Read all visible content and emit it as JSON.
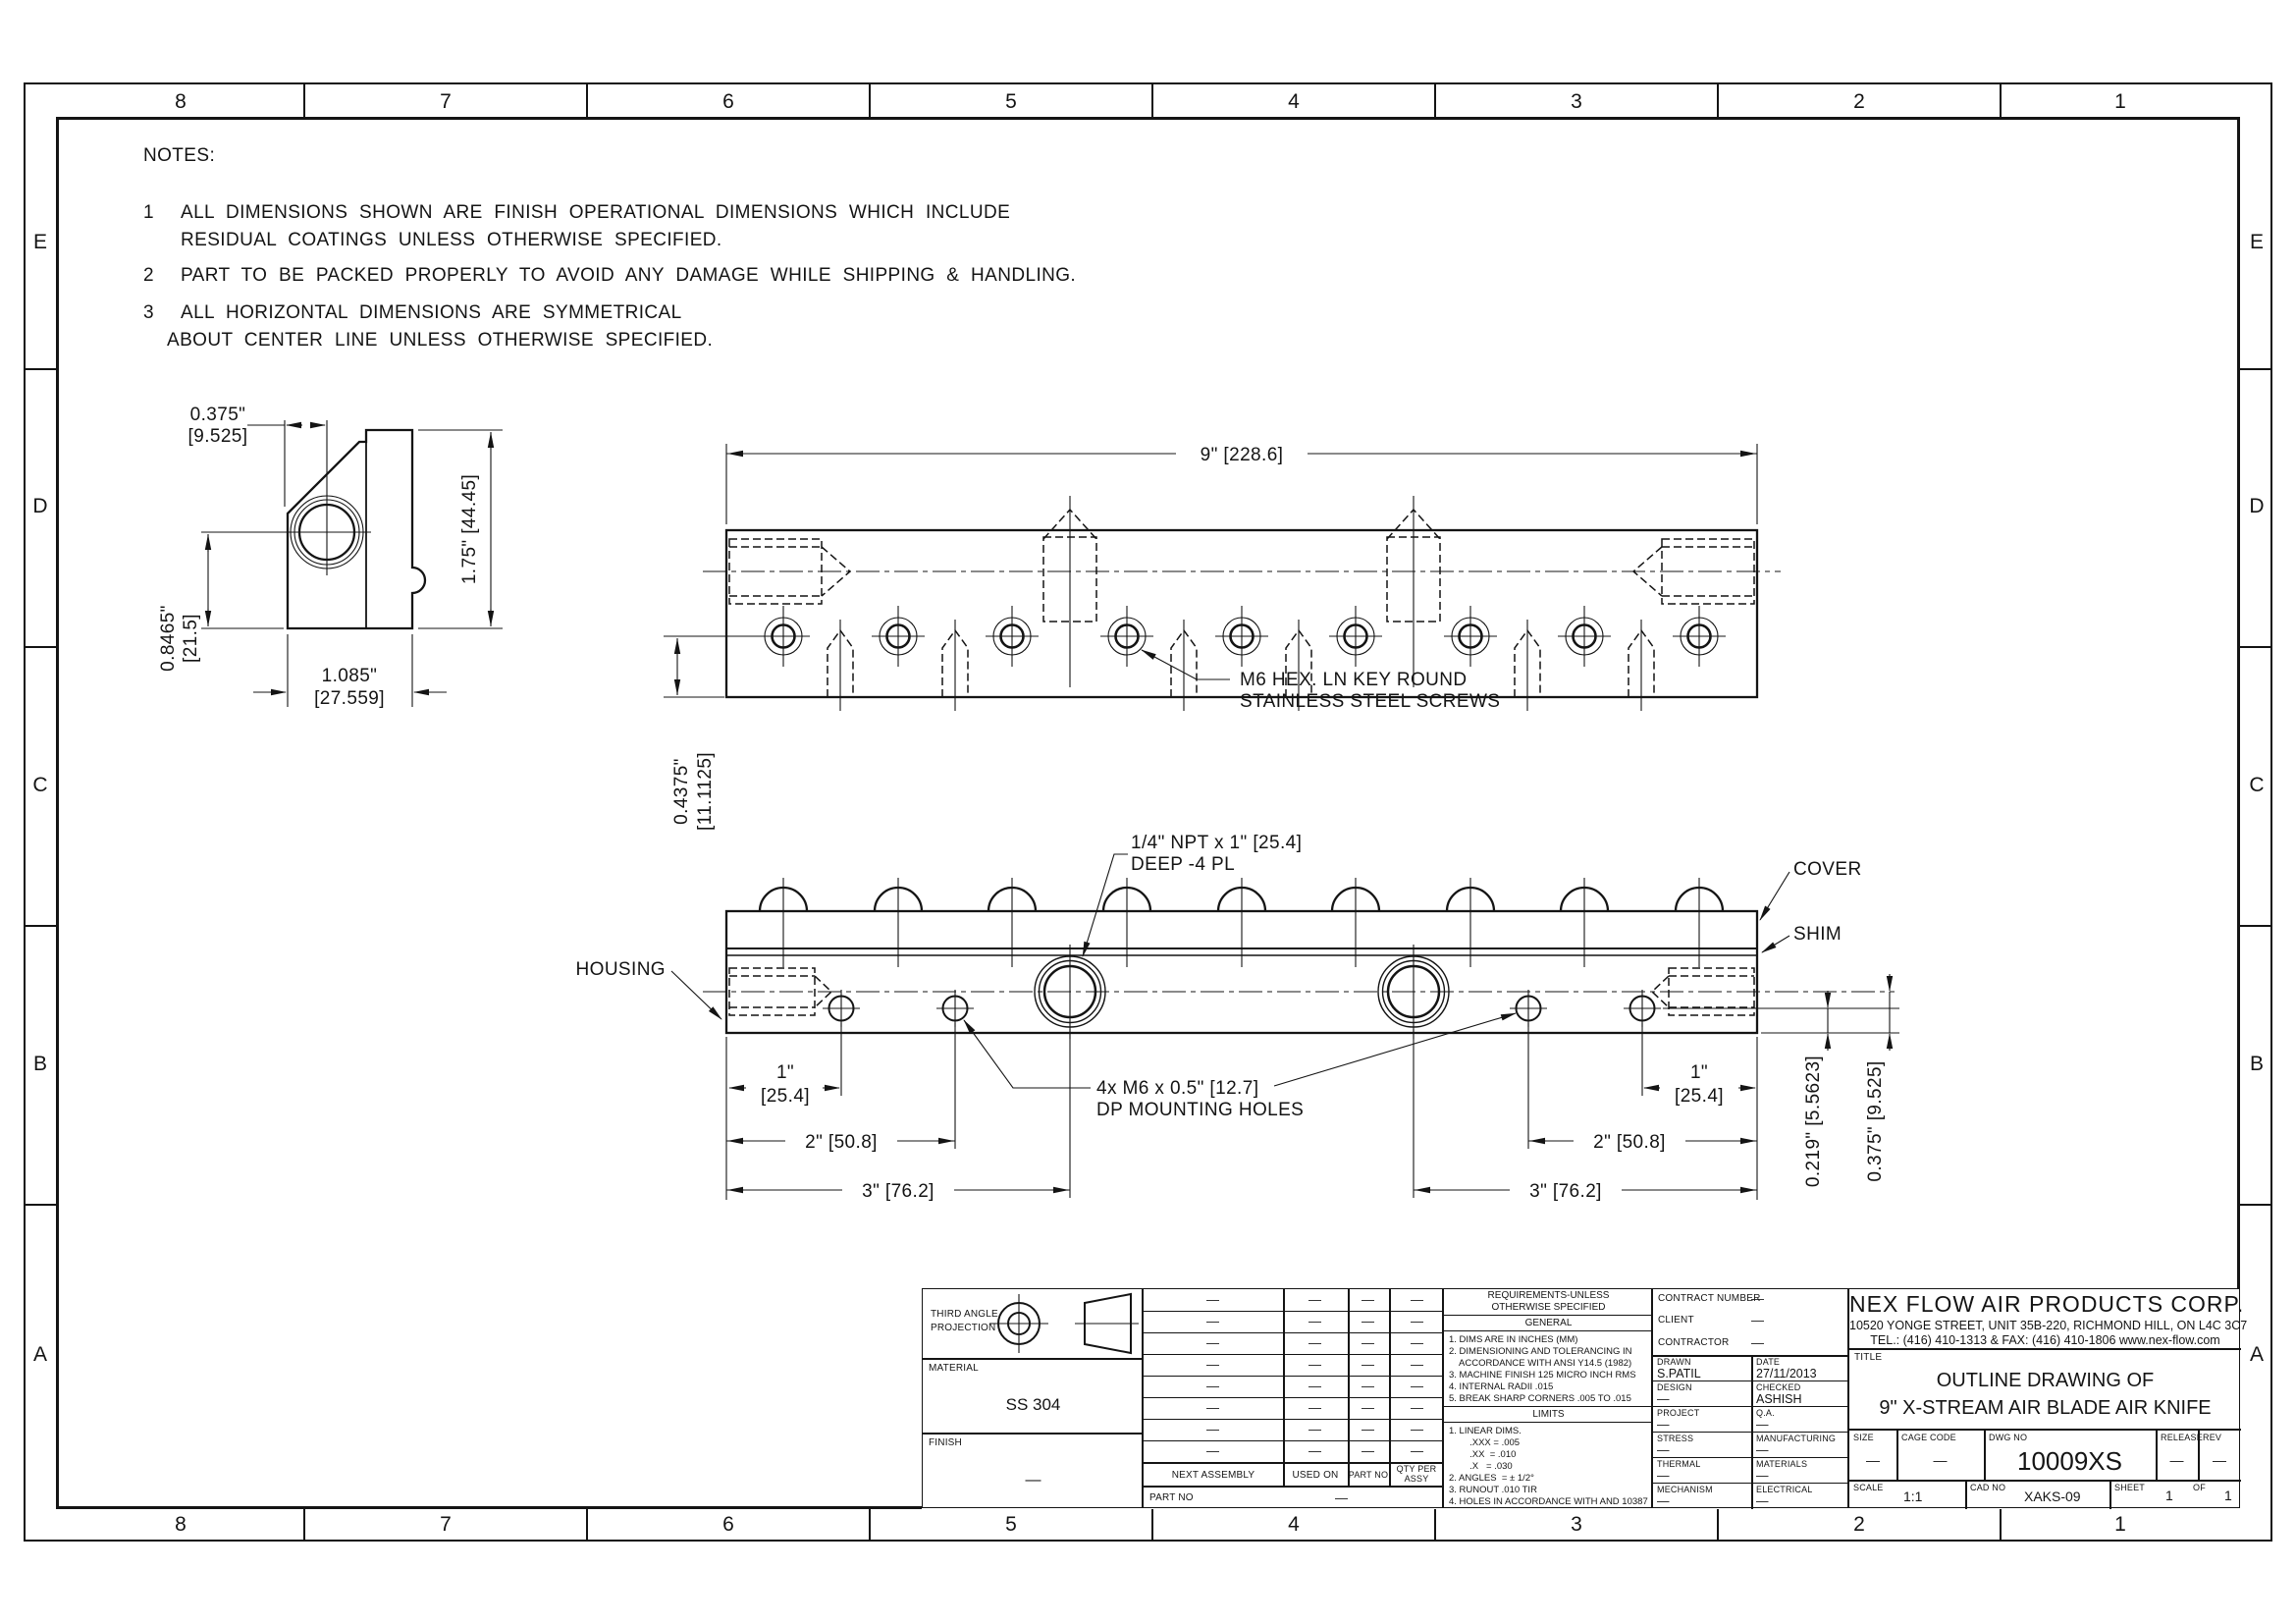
{
  "zones": {
    "cols": [
      "8",
      "7",
      "6",
      "5",
      "4",
      "3",
      "2",
      "1"
    ],
    "rows": [
      "E",
      "D",
      "C",
      "B",
      "A"
    ]
  },
  "notes": {
    "heading": "NOTES:",
    "n1_num": "1",
    "n1_line1": "ALL DIMENSIONS SHOWN ARE FINISH OPERATIONAL DIMENSIONS WHICH INCLUDE",
    "n1_line2": "RESIDUAL COATINGS UNLESS OTHERWISE SPECIFIED.",
    "n2_num": "2",
    "n2_line1": "PART TO BE PACKED PROPERLY TO AVOID ANY DAMAGE WHILE SHIPPING & HANDLING.",
    "n3_num": "3",
    "n3_line1": "ALL HORIZONTAL DIMENSIONS ARE SYMMETRICAL",
    "n3_line2": "ABOUT CENTER LINE UNLESS OTHERWISE SPECIFIED."
  },
  "side_view": {
    "dim_top_in": "0.375\"",
    "dim_top_mm": "[9.525]",
    "dim_height": "1.75\" [44.45]",
    "dim_left_in": "0.8465\"",
    "dim_left_mm": "[21.5]",
    "dim_bottom_in": "1.085\"",
    "dim_bottom_mm": "[27.559]"
  },
  "top_view": {
    "dim_overall": "9\" [228.6]",
    "dim_screw_in": "0.4375\"",
    "dim_screw_mm": "[11.1125]",
    "screw_note_1": "M6 HEX. LN KEY ROUND",
    "screw_note_2": "STAINLESS STEEL SCREWS"
  },
  "front_view": {
    "label_housing": "HOUSING",
    "label_cover": "COVER",
    "label_shim": "SHIM",
    "npt_note_1": "1/4\" NPT x 1\" [25.4]",
    "npt_note_2": "DEEP -4 PL",
    "mount_note_1": "4x M6 x 0.5\" [12.7]",
    "mount_note_2": "DP MOUNTING HOLES",
    "dim_1in": "1\"",
    "dim_1mm": "[25.4]",
    "dim_2": "2\" [50.8]",
    "dim_3": "3\" [76.2]",
    "dim_v1": "0.219\" [5.5623]",
    "dim_v2": "0.375\" [9.525]"
  },
  "title_block": {
    "projection_label_1": "THIRD ANGLE",
    "projection_label_2": "PROJECTION",
    "material_label": "MATERIAL",
    "material_value": "SS 304",
    "finish_label": "FINISH",
    "finish_value": "—",
    "parts_table": {
      "dash": "—",
      "header_1": "NEXT ASSEMBLY",
      "header_2": "USED ON",
      "header_3": "QTY PER ASSY",
      "header_4": "PART NO",
      "part_no_label": "PART NO",
      "part_no_value": "—"
    },
    "requirements": {
      "title_1": "REQUIREMENTS-UNLESS",
      "title_2": "OTHERWISE SPECIFIED",
      "general_header": "GENERAL",
      "general_items": [
        "1. DIMS ARE IN INCHES (MM)",
        "2. DIMENSIONING AND TOLERANCING IN",
        "    ACCORDANCE WITH ANSI Y14.5 (1982)",
        "3. MACHINE FINISH 125 MICRO INCH RMS",
        "4. INTERNAL RADII .015",
        "5. BREAK SHARP CORNERS .005 TO .015"
      ],
      "limits_header": "LIMITS",
      "limits_items": [
        "1. LINEAR DIMS.",
        "        .XXX = .005",
        "        .XX  = .010",
        "        .X   = .030",
        "2. ANGLES  = ± 1/2°",
        "3. RUNOUT .010 TIR",
        "4. HOLES IN ACCORDANCE WITH AND 10387"
      ]
    },
    "signoff": {
      "contract_label": "CONTRACT NUMBER",
      "contract_value": "—",
      "client_label": "CLIENT",
      "client_value": "—",
      "contractor_label": "CONTRACTOR",
      "contractor_value": "—",
      "rows": [
        {
          "l_label": "DRAWN",
          "l_value": "S.PATIL",
          "r_label": "DATE",
          "r_value": "27/11/2013"
        },
        {
          "l_label": "DESIGN",
          "l_value": "—",
          "r_label": "CHECKED",
          "r_value": "ASHISH"
        },
        {
          "l_label": "PROJECT",
          "l_value": "—",
          "r_label": "Q.A.",
          "r_value": "—"
        },
        {
          "l_label": "STRESS",
          "l_value": "—",
          "r_label": "MANUFACTURING",
          "r_value": "—"
        },
        {
          "l_label": "THERMAL",
          "l_value": "—",
          "r_label": "MATERIALS",
          "r_value": "—"
        },
        {
          "l_label": "MECHANISM",
          "l_value": "—",
          "r_label": "ELECTRICAL",
          "r_value": "—"
        }
      ]
    },
    "company": {
      "name": "NEX FLOW AIR PRODUCTS CORP.",
      "address": "10520 YONGE STREET, UNIT 35B-220, RICHMOND HILL, ON L4C 3C7",
      "contact": "TEL.: (416) 410-1313 & FAX: (416) 410-1806 www.nex-flow.com",
      "title_label": "TITLE",
      "title_1": "OUTLINE DRAWING OF",
      "title_2": "9\" X-STREAM AIR BLADE AIR KNIFE",
      "size_label": "SIZE",
      "size_value": "—",
      "cage_label": "CAGE CODE",
      "cage_value": "—",
      "dwg_label": "DWG NO",
      "dwg_value": "10009XS",
      "release_label": "RELEASE",
      "release_value": "—",
      "rev_label": "REV",
      "rev_value": "—",
      "scale_label": "SCALE",
      "scale_value": "1:1",
      "cad_label": "CAD NO",
      "cad_value": "XAKS-09",
      "sheet_label": "SHEET",
      "sheet_value": "1",
      "of_label": "OF",
      "of_value": "1"
    }
  }
}
